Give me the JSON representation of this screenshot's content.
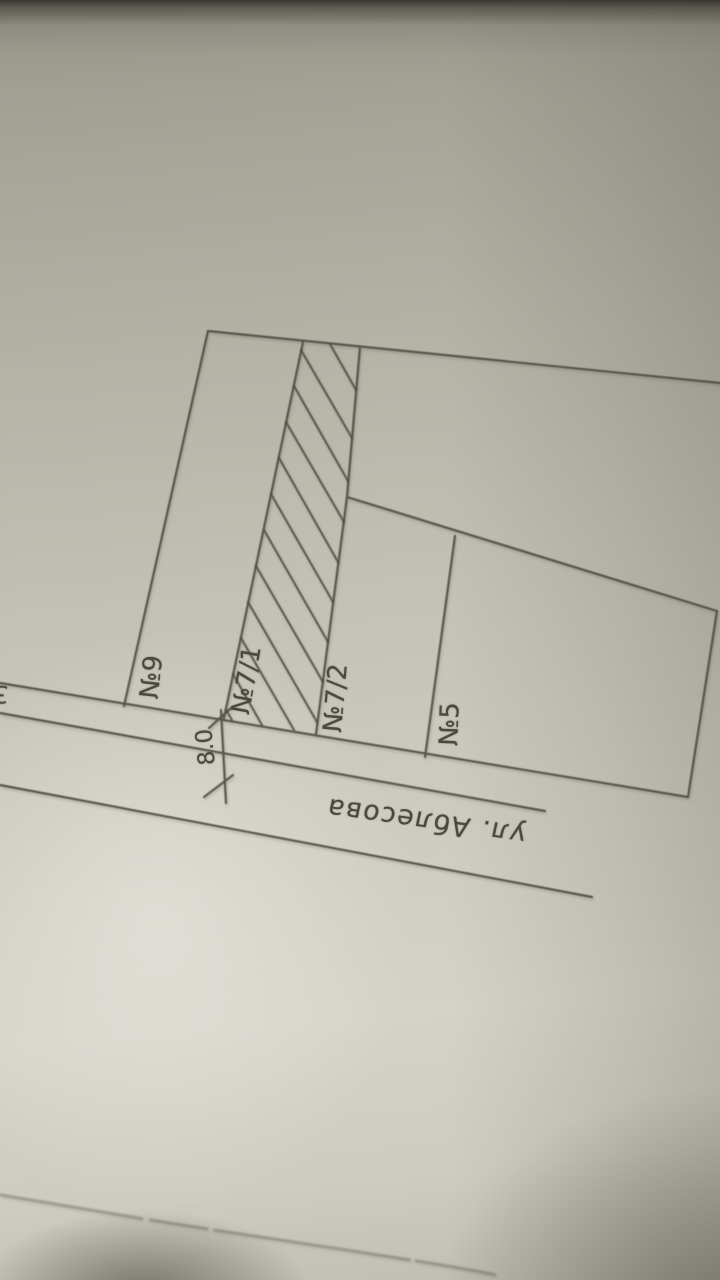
{
  "plan": {
    "street_label": "ул. Аблесова",
    "plot_labels": {
      "p9": "№9",
      "p7_1": "№7/1",
      "p7_2": "№7/2",
      "p5": "№5"
    },
    "road_width_dimension": "8.0",
    "clipped_edge_character": "3",
    "hatched_plot": "№7/1",
    "colors": {
      "paper": "#c6c3b8",
      "ink": "#4f4c42",
      "shadow": "#34322b"
    }
  }
}
